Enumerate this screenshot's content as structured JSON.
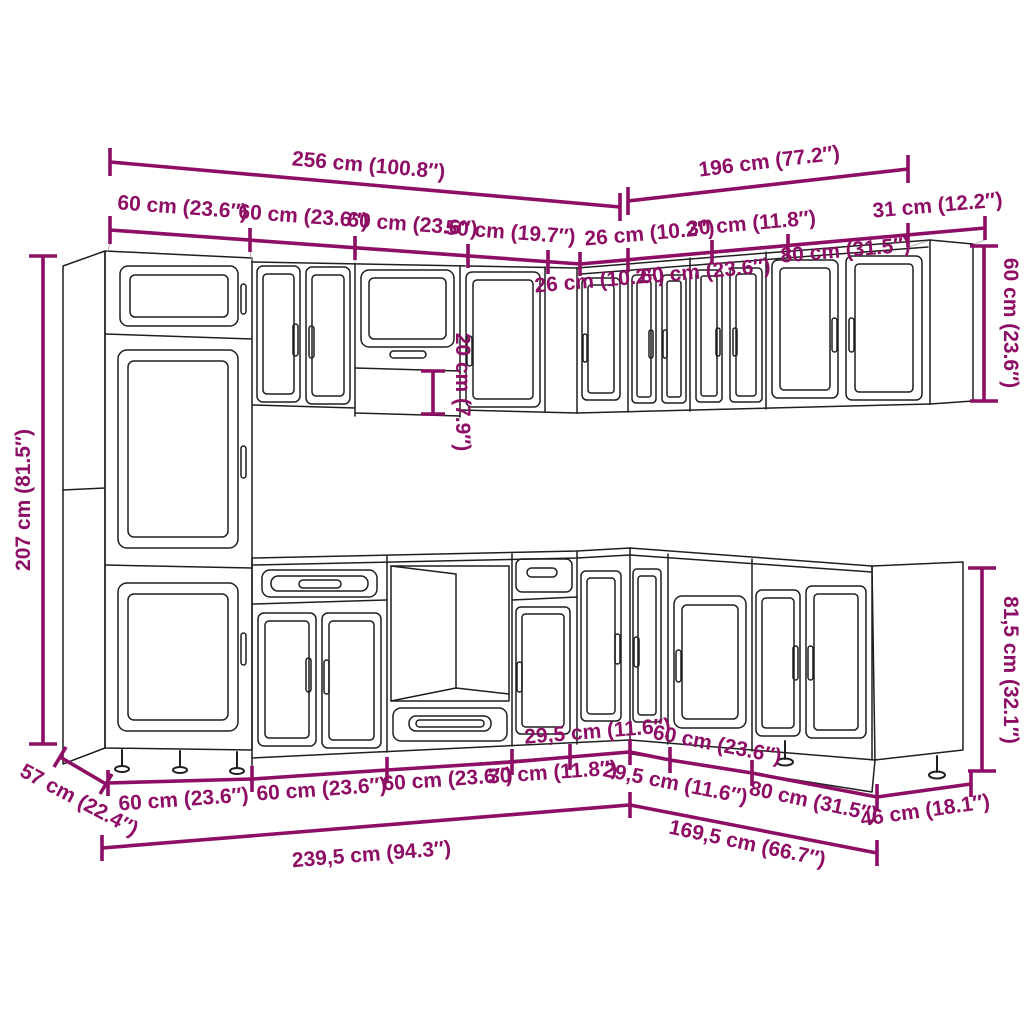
{
  "diagram": {
    "kind": "kitchen-cabinet-set-dimension-diagram",
    "accent_color": "#8e0e66",
    "line_color": "#1f1f1f",
    "background_color": "#ffffff"
  },
  "dimensions": {
    "total_width_left_wing": "256 cm (100.8″)",
    "total_width_right_wing": "196 cm (77.2″)",
    "wall_left_1": "60 cm (23.6″)",
    "wall_left_2": "60 cm (23.6″)",
    "wall_left_3": "60 cm (23.6″)",
    "wall_left_4": "50 cm (19.7″)",
    "wall_right_corner_1": "26 cm (10.2″)",
    "wall_right_corner_2": "30 cm (11.8″)",
    "wall_end_depth": "31 cm (12.2″)",
    "wall_right_1": "26 cm (10.2″)",
    "wall_right_2": "60 cm (23.6″)",
    "wall_right_3": "80 cm (31.5″)",
    "tall_cabinet_height": "207 cm (81.5″)",
    "wall_gap_height": "20 cm (7.9″)",
    "wall_cabinet_height": "60 cm (23.6″)",
    "base_cabinet_height": "81,5 cm (32.1″)",
    "tall_cabinet_depth": "57 cm (22.4″)",
    "base_left_1": "60 cm (23.6″)",
    "base_left_2": "60 cm (23.6″)",
    "base_left_3": "60 cm (23.6″)",
    "base_left_4": "30 cm (11.8″)",
    "base_corner_left": "29,5 cm (11.6″)",
    "base_corner_right": "29,5 cm (11.6″)",
    "base_right_1": "60 cm (23.6″)",
    "base_right_2": "80 cm (31.5″)",
    "base_end_depth": "46 cm (18.1″)",
    "base_total_left": "239,5 cm (94.3″)",
    "base_total_right": "169,5 cm (66.7″)"
  }
}
